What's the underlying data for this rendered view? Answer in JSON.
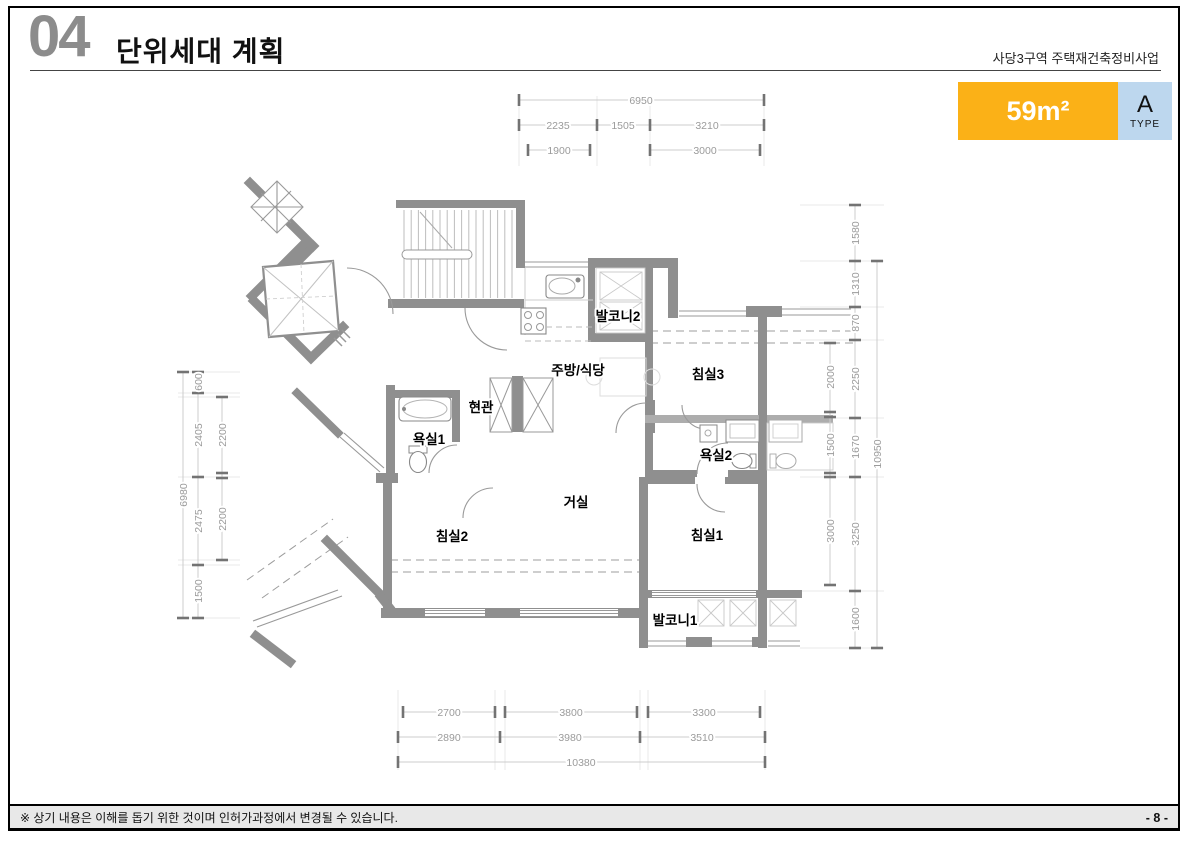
{
  "header": {
    "section_number": "04",
    "title": "단위세대 계획",
    "project_name": "사당3구역 주택재건축정비사업"
  },
  "type_badge": {
    "area_label": "59m²",
    "type_letter": "A",
    "type_word": "TYPE",
    "area_bg_color": "#FBB117",
    "type_bg_color": "#BDD7EE"
  },
  "footer": {
    "note": "※ 상기 내용은 이해를 돕기 위한 것이며 인허가과정에서 변경될 수 있습니다.",
    "page_number": "- 8 -"
  },
  "floor_plan": {
    "unit_type": "A",
    "unit_area": "59m²",
    "wall_color": "#8F8F8F",
    "dim_text_color": "#9B9B9B",
    "room_labels": [
      {
        "name": "balcony-2",
        "label": "발코니2",
        "x": 618,
        "y": 321
      },
      {
        "name": "kitchen-dining",
        "label": "주방/식당",
        "x": 578,
        "y": 375
      },
      {
        "name": "bedroom-3",
        "label": "침실3",
        "x": 708,
        "y": 379
      },
      {
        "name": "entrance",
        "label": "현관",
        "x": 481,
        "y": 412
      },
      {
        "name": "bathroom-1",
        "label": "욕실1",
        "x": 429,
        "y": 444
      },
      {
        "name": "bathroom-2",
        "label": "욕실2",
        "x": 716,
        "y": 460
      },
      {
        "name": "living-room",
        "label": "거실",
        "x": 576,
        "y": 507
      },
      {
        "name": "bedroom-2",
        "label": "침실2",
        "x": 452,
        "y": 541
      },
      {
        "name": "bedroom-1",
        "label": "침실1",
        "x": 707,
        "y": 540
      },
      {
        "name": "balcony-1",
        "label": "발코니1",
        "x": 675,
        "y": 625
      }
    ],
    "dimension_labels": [
      {
        "text": "6950",
        "x": 641,
        "y": 104,
        "rot": false
      },
      {
        "text": "2235",
        "x": 558,
        "y": 129,
        "rot": false
      },
      {
        "text": "1505",
        "x": 623,
        "y": 129,
        "rot": false
      },
      {
        "text": "3210",
        "x": 707,
        "y": 129,
        "rot": false
      },
      {
        "text": "1900",
        "x": 559,
        "y": 154,
        "rot": false
      },
      {
        "text": "3000",
        "x": 705,
        "y": 154,
        "rot": false
      },
      {
        "text": "2700",
        "x": 449,
        "y": 716,
        "rot": false
      },
      {
        "text": "3800",
        "x": 571,
        "y": 716,
        "rot": false
      },
      {
        "text": "3300",
        "x": 704,
        "y": 716,
        "rot": false
      },
      {
        "text": "2890",
        "x": 449,
        "y": 741,
        "rot": false
      },
      {
        "text": "3980",
        "x": 570,
        "y": 741,
        "rot": false
      },
      {
        "text": "3510",
        "x": 702,
        "y": 741,
        "rot": false
      },
      {
        "text": "10380",
        "x": 581,
        "y": 766,
        "rot": false
      },
      {
        "text": "600",
        "x": 202,
        "y": 382,
        "rot": true
      },
      {
        "text": "2405",
        "x": 202,
        "y": 435,
        "rot": true
      },
      {
        "text": "2475",
        "x": 202,
        "y": 521,
        "rot": true
      },
      {
        "text": "1500",
        "x": 202,
        "y": 591,
        "rot": true
      },
      {
        "text": "2200",
        "x": 226,
        "y": 435,
        "rot": true
      },
      {
        "text": "2200",
        "x": 226,
        "y": 519,
        "rot": true
      },
      {
        "text": "6980",
        "x": 187,
        "y": 495,
        "rot": true
      },
      {
        "text": "2000",
        "x": 834,
        "y": 377,
        "rot": true
      },
      {
        "text": "1500",
        "x": 834,
        "y": 445,
        "rot": true
      },
      {
        "text": "3000",
        "x": 834,
        "y": 531,
        "rot": true
      },
      {
        "text": "1580",
        "x": 859,
        "y": 233,
        "rot": true
      },
      {
        "text": "1310",
        "x": 859,
        "y": 284,
        "rot": true
      },
      {
        "text": "870",
        "x": 859,
        "y": 323,
        "rot": true
      },
      {
        "text": "2250",
        "x": 859,
        "y": 379,
        "rot": true
      },
      {
        "text": "1670",
        "x": 859,
        "y": 447,
        "rot": true
      },
      {
        "text": "3250",
        "x": 859,
        "y": 534,
        "rot": true
      },
      {
        "text": "1600",
        "x": 859,
        "y": 619,
        "rot": true
      },
      {
        "text": "10950",
        "x": 881,
        "y": 454,
        "rot": true
      }
    ]
  }
}
